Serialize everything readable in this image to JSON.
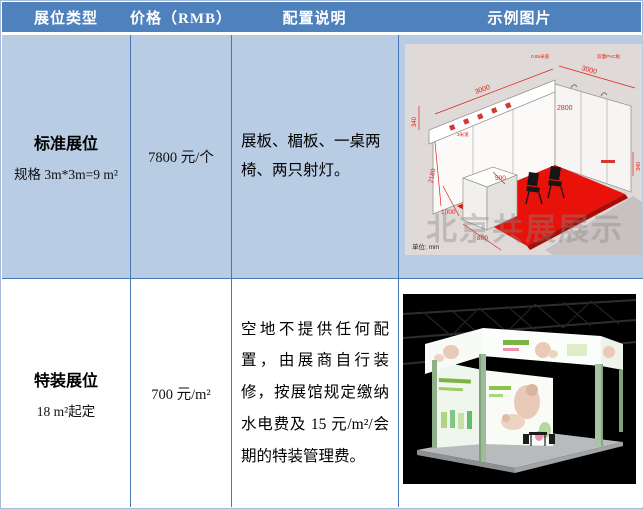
{
  "table": {
    "columns": [
      {
        "label": "展位类型"
      },
      {
        "label": "价格（RMB）"
      },
      {
        "label": "配置说明"
      },
      {
        "label": "示例图片"
      }
    ],
    "rows": [
      {
        "type_title": "标准展位",
        "type_sub": "规格 3m*3m=9 m²",
        "price": "7800 元/个",
        "config": "展板、楣板、一桌两椅、两只射灯。",
        "image_kind": "standard-booth-dimension-diagram"
      },
      {
        "type_title": "特装展位",
        "type_sub": "18 m²起定",
        "price": "700 元/m²",
        "config": "空地不提供任何配置，由展商自行装修，按展馆规定缴纳水电费及 15 元/m²/会期的特装管理费。",
        "image_kind": "custom-booth-render-photo"
      }
    ]
  },
  "booth_diagram": {
    "dim_top_left": "3000",
    "dim_top_right": "3000",
    "dim_wall_height": "2800",
    "dim_left_small": "340",
    "dim_right_small": "340",
    "dim_left_vertical": "2180",
    "dim_counter_1000": "1000",
    "dim_counter_800": "800",
    "dim_counter_500": "500",
    "note_top": "0.85米道",
    "note_pvc": "双面PVC板",
    "note_aisle": "3米道",
    "unit_label": "单位: mm",
    "watermark": "北京共展展示"
  },
  "colors": {
    "header_bg": "#4F81BD",
    "row1_bg": "#B8CCE4",
    "grid_line": "#4778B3",
    "diagram_bg": "#DFD9D8",
    "carpet_red": "#E8120B",
    "dimension_red": "#DE231C",
    "booth_green": "#9CBB98",
    "photo_bg": "#000000"
  }
}
